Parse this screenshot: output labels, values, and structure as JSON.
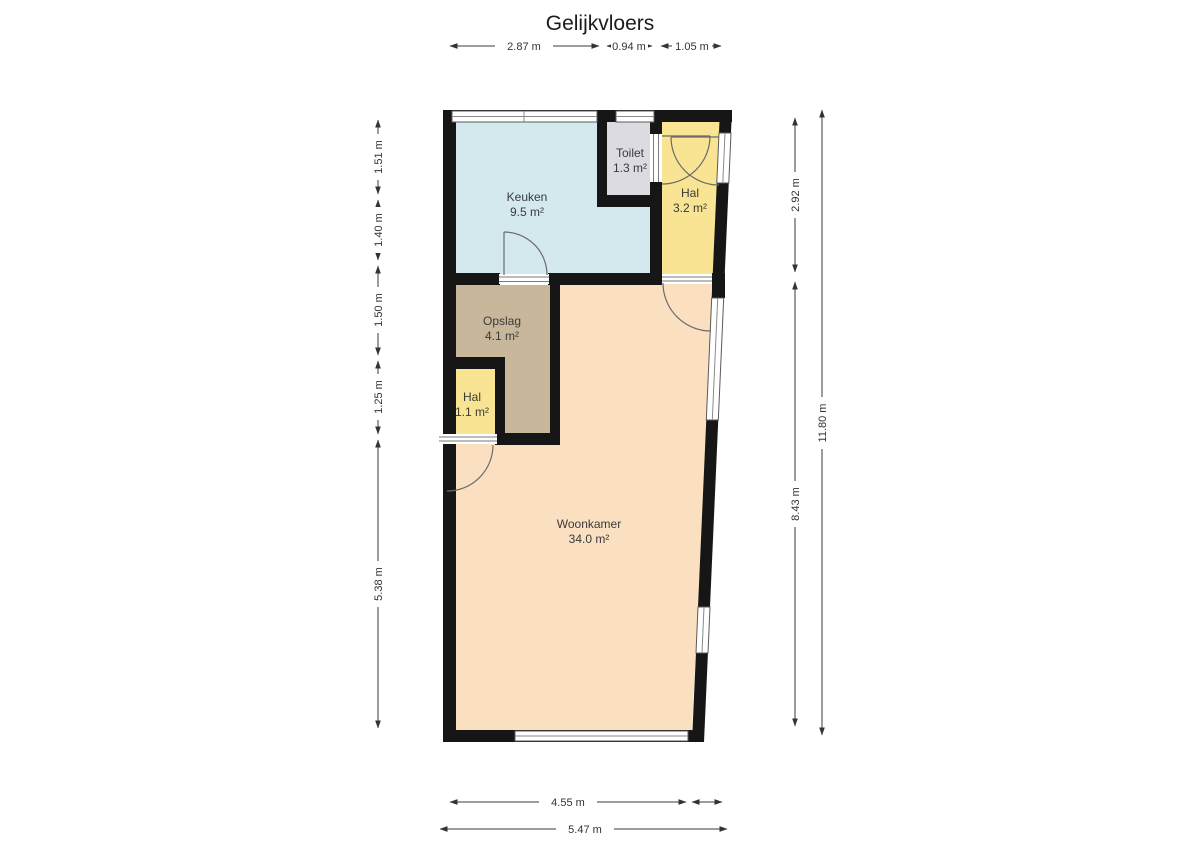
{
  "title": "Gelijkvloers",
  "colors": {
    "wall": "#161616",
    "keuken": "#d3e9ee",
    "toilet": "#dcdbe2",
    "hal": "#f8e492",
    "opslag": "#c9b79b",
    "woonkamer": "#fadfc1"
  },
  "rooms": {
    "keuken": {
      "name": "Keuken",
      "area": "9.5 m²"
    },
    "toilet": {
      "name": "Toilet",
      "area": "1.3 m²"
    },
    "hal_boven": {
      "name": "Hal",
      "area": "3.2 m²"
    },
    "opslag": {
      "name": "Opslag",
      "area": "4.1 m²"
    },
    "hal_onder": {
      "name": "Hal",
      "area": "1.1 m²"
    },
    "woonkamer": {
      "name": "Woonkamer",
      "area": "34.0 m²"
    }
  },
  "dimensions": {
    "top": {
      "d1": "2.87 m",
      "d2": "0.94 m",
      "d3": "1.05 m"
    },
    "left": {
      "d1": "1.51 m",
      "d2": "1.40 m",
      "d3": "1.50 m",
      "d4": "1.25 m",
      "d5": "5.38 m"
    },
    "right": {
      "d1": "2.92 m",
      "d2": "8.43 m",
      "d3": "11.80 m"
    },
    "bottom": {
      "d1": "4.55 m",
      "d2": "5.47 m"
    }
  }
}
